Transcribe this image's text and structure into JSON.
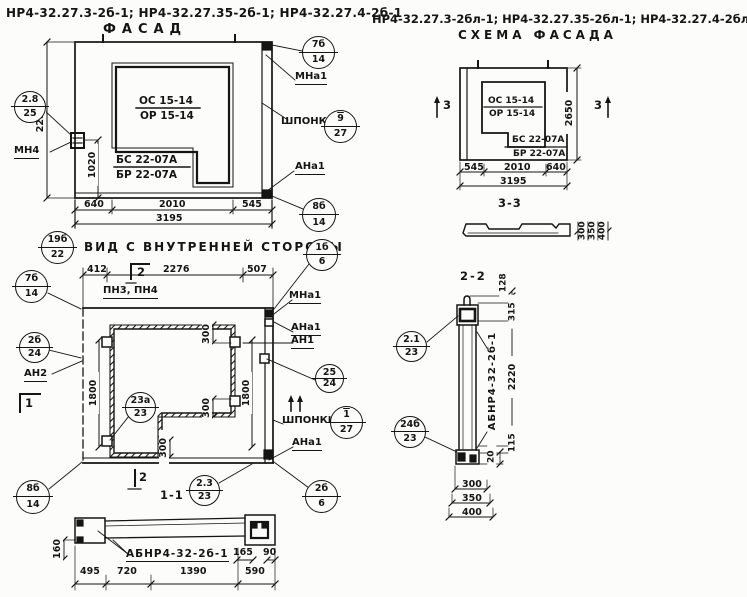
{
  "titles": {
    "left1": "НР4-32.27.3-2б-1; НР4-32.27.35-2б-1; НР4-32.27.4-2б-1",
    "left2": "ФАСАД",
    "right1": "НР4-32.27.3-2бл-1; НР4-32.27.35-2бл-1; НР4-32.27.4-2бл-1",
    "right2": "СХЕМА ФАСАДА",
    "inner": "ВИД С ВНУТРЕННЕЙ СТОРОНЫ",
    "sec11": "1-1",
    "sec22": "2-2",
    "sec33": "3-3"
  },
  "marks": {
    "os": "ОС 15-14",
    "or": "ОР 15-14",
    "bs": "БС 22-07А",
    "br": "БР 22-07А",
    "abnr": "АБНР4-32-2б-1"
  },
  "labels": {
    "mn4": "МН4",
    "mna1": "МНа1",
    "shponki": "ШПОНКИ",
    "ana1": "АНа1",
    "an1": "АН1",
    "an2": "АН2",
    "pn": "ПН3, ПН4"
  },
  "markers": {
    "m1": "1",
    "m2": "2",
    "m3": "3"
  },
  "dims": {
    "facade": {
      "h": "2250",
      "v1020": "1020",
      "b1": "640",
      "b2": "2010",
      "b3": "545",
      "total": "3195"
    },
    "scheme": {
      "h": "2650",
      "b1": "545",
      "b2": "2010",
      "b3": "640",
      "total": "3195",
      "d33": [
        "300",
        "350",
        "400"
      ]
    },
    "inner": {
      "t1": "412",
      "t2": "2276",
      "t3": "507",
      "v": "1800",
      "v300": "300"
    },
    "s11": {
      "d160": "160",
      "b1": "495",
      "b2": "720",
      "b3": "1390",
      "b4": "590",
      "d165": "165",
      "d90": "90"
    },
    "s22": {
      "d128": "128",
      "d315": "315",
      "d2220": "2220",
      "d115": "115",
      "d20": "20",
      "w1": "300",
      "w2": "350",
      "w3": "400"
    }
  },
  "balloons": {
    "f_left": {
      "top": "2.8",
      "bottom": "25"
    },
    "f_7b": {
      "top": "7б",
      "bottom": "14"
    },
    "f_shp": {
      "top": "9",
      "bottom": "27"
    },
    "f_8b": {
      "top": "8б",
      "bottom": "14"
    },
    "v_19b": {
      "top": "19б",
      "bottom": "22"
    },
    "v_7b": {
      "top": "7б",
      "bottom": "14"
    },
    "v_2b24": {
      "top": "2б",
      "bottom": "24"
    },
    "v_8b": {
      "top": "8б",
      "bottom": "14"
    },
    "v_1b6": {
      "top": "1б",
      "bottom": "6"
    },
    "v_2524": {
      "top": "25",
      "bottom": "24"
    },
    "v_shp": {
      "top": "1",
      "bottom": "27"
    },
    "v_23a": {
      "top": "23а",
      "bottom": "23"
    },
    "v_2323": {
      "top": "2.3",
      "bottom": "23"
    },
    "v_2b6": {
      "top": "2б",
      "bottom": "6"
    },
    "s_21": {
      "top": "2.1",
      "bottom": "23"
    },
    "s_24b": {
      "top": "24б",
      "bottom": "23"
    }
  }
}
